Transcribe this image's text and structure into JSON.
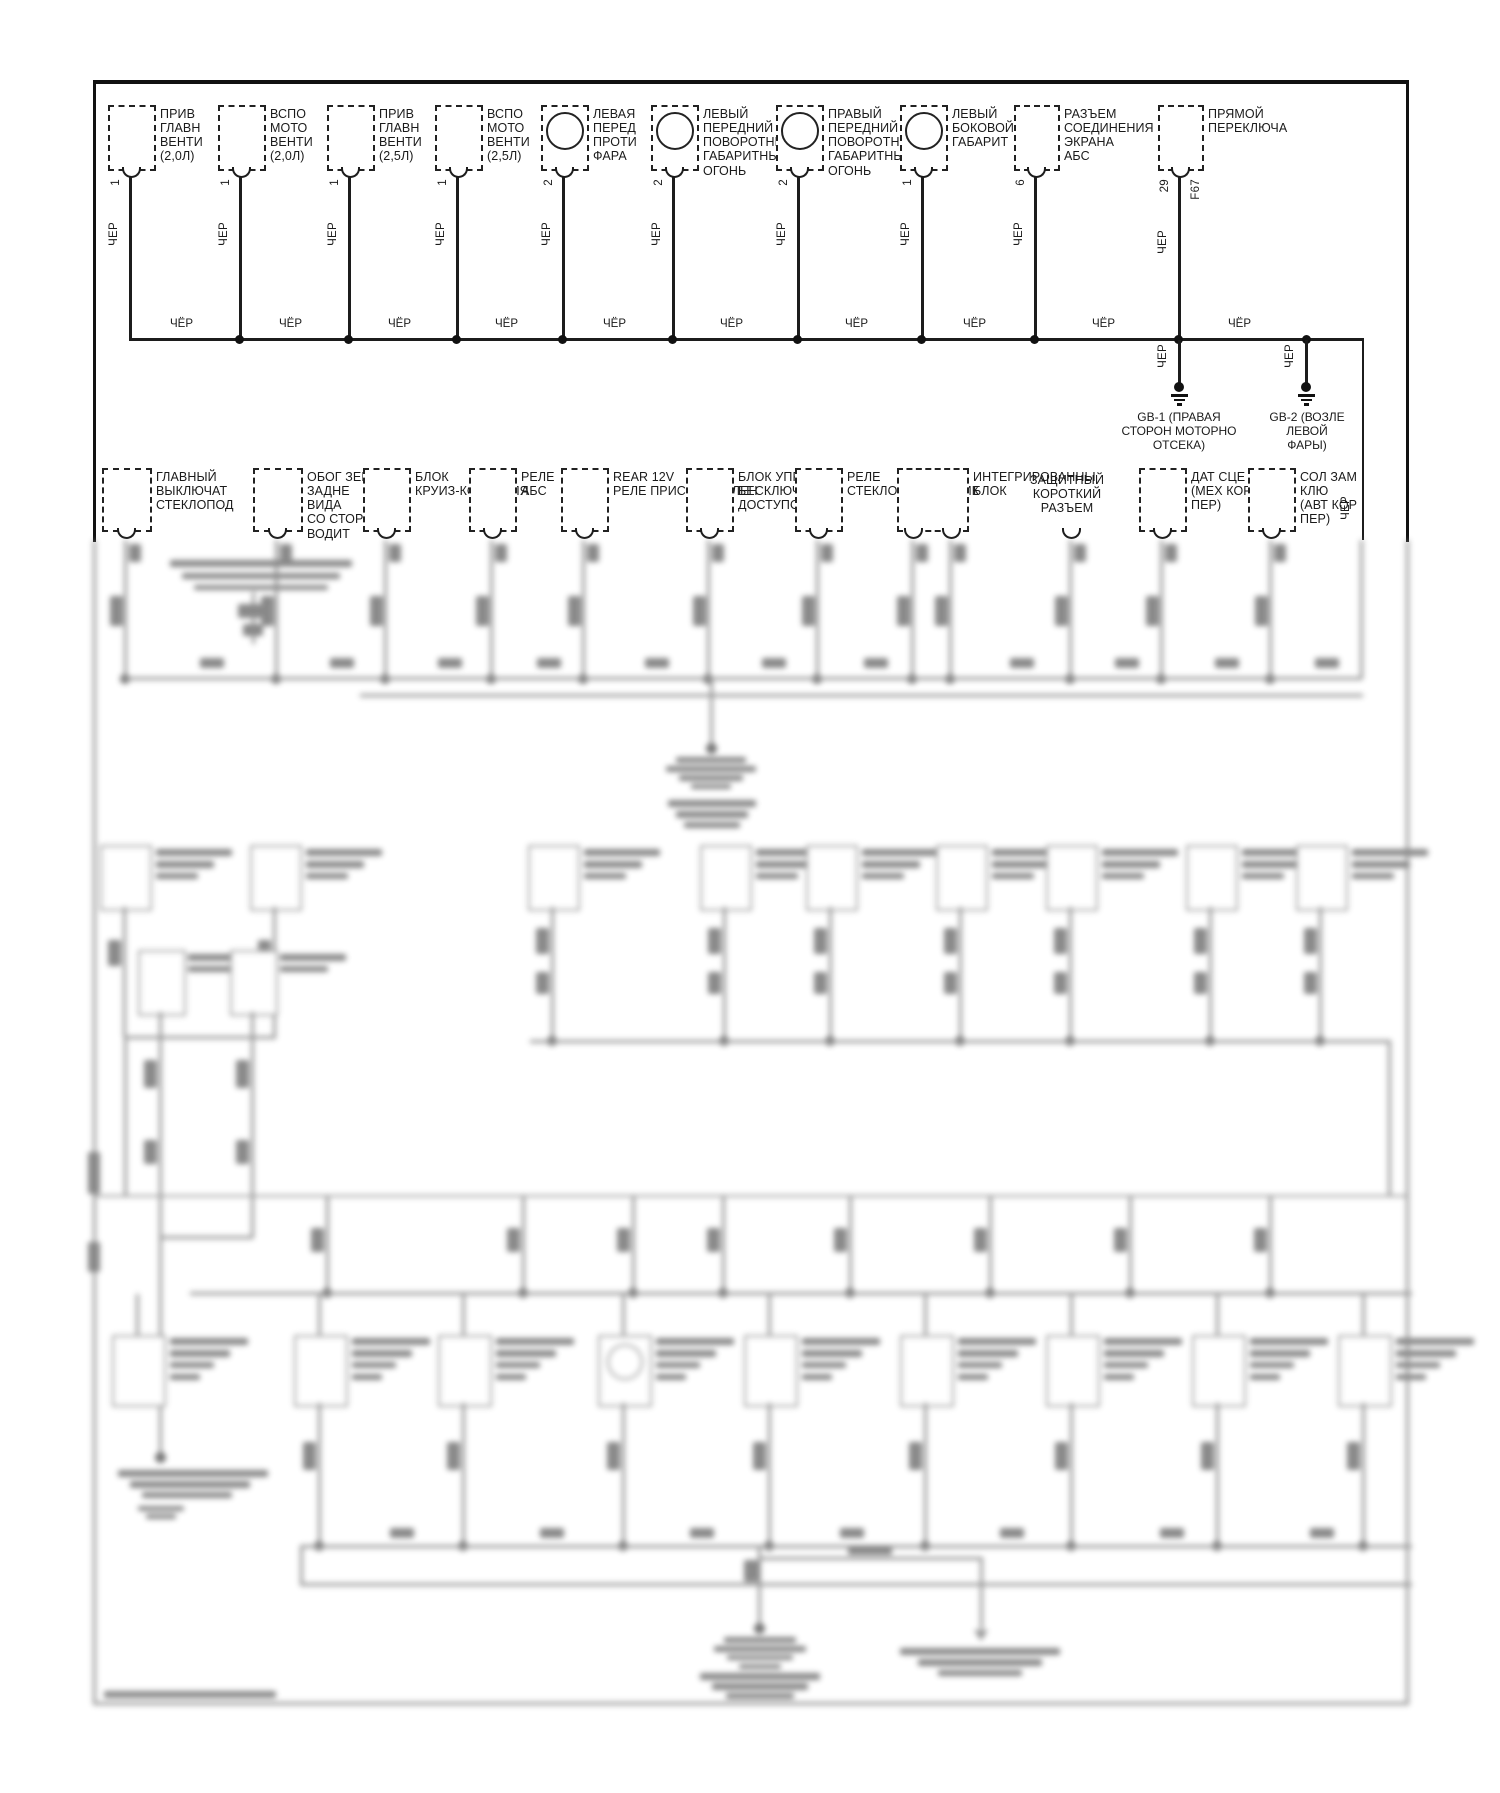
{
  "wire_color_label": "ЧЁР",
  "top_row": {
    "components": [
      {
        "label": "ПРИВ\nГЛАВН\nВЕНТИ\n(2,0Л)",
        "pin": "1"
      },
      {
        "label": "ВСПО\nМОТО\nВЕНТИ\n(2,0Л)",
        "pin": "1"
      },
      {
        "label": "ПРИВ\nГЛАВН\nВЕНТИ\n(2,5Л)",
        "pin": "1"
      },
      {
        "label": "ВСПО\nМОТО\nВЕНТИ\n(2,5Л)",
        "pin": "1"
      },
      {
        "label": "ЛЕВАЯ\nПЕРЕД\nПРОТИ\nФАРА",
        "pin": "2"
      },
      {
        "label": "ЛЕВЫЙ\nПЕРЕДНИЙ\nПОВОРОТНИ,\nГАБАРИТНЫ\nОГОНЬ",
        "pin": "2"
      },
      {
        "label": "ПРАВЫЙ\nПЕРЕДНИЙ\nПОВОРОТНИ,\nГАБАРИТНЫ\nОГОНЬ",
        "pin": "2"
      },
      {
        "label": "ЛЕВЫЙ\nБОКОВОЙ\nГАБАРИТ",
        "pin": "1"
      },
      {
        "label": "РАЗЪЕМ\nСОЕДИНЕНИЯ\nЭКРАНА\nАБС",
        "pin": "6"
      },
      {
        "label": "ПРЯМОЙ\nПЕРЕКЛЮЧА",
        "pin": "29",
        "connector_code": "F67"
      }
    ]
  },
  "grounds": [
    {
      "label": "GB-1 (ПРАВАЯ\nСТОРОН МОТОРНО\nОТСЕКА)"
    },
    {
      "label": "GB-2 (ВОЗЛЕ\nЛЕВОЙ\nФАРЫ)"
    }
  ],
  "second_row": {
    "components": [
      {
        "label": "ГЛАВНЫЙ\nВЫКЛЮЧАТ\nСТЕКЛОПОД"
      },
      {
        "label": "ОБОГ ЗЕРКА\nЗАДНЕ\nВИДА\nСО СТОРО\nВОДИТ"
      },
      {
        "label": "БЛОК\nКРУИЗ-КОНТРОЛЯ"
      },
      {
        "label": "РЕЛЕ\nАБС"
      },
      {
        "label": "REAR 12V\nРЕЛЕ ПРИСПОСОБЛЕН"
      },
      {
        "label": "БЛОК УПРАВЛЕ\nБЕСКЛЮЧЕ\nДОСТУПОМ"
      },
      {
        "label": "РЕЛЕ\nСТЕКЛОПОДЪЕМНИК"
      },
      {
        "label": "ИНТЕГРИРОВАННЫ\nБЛОК"
      },
      {
        "label": "ЗАЩИТНЫЙ\nКОРОТКИЙ\nРАЗЪЕМ"
      },
      {
        "label": "ДАТ СЦЕ\n(МЕХ КОР\nПЕР)"
      },
      {
        "label": "СОЛ ЗАМ\nКЛЮ\n(АВТ КОР\nПЕР)"
      }
    ]
  }
}
